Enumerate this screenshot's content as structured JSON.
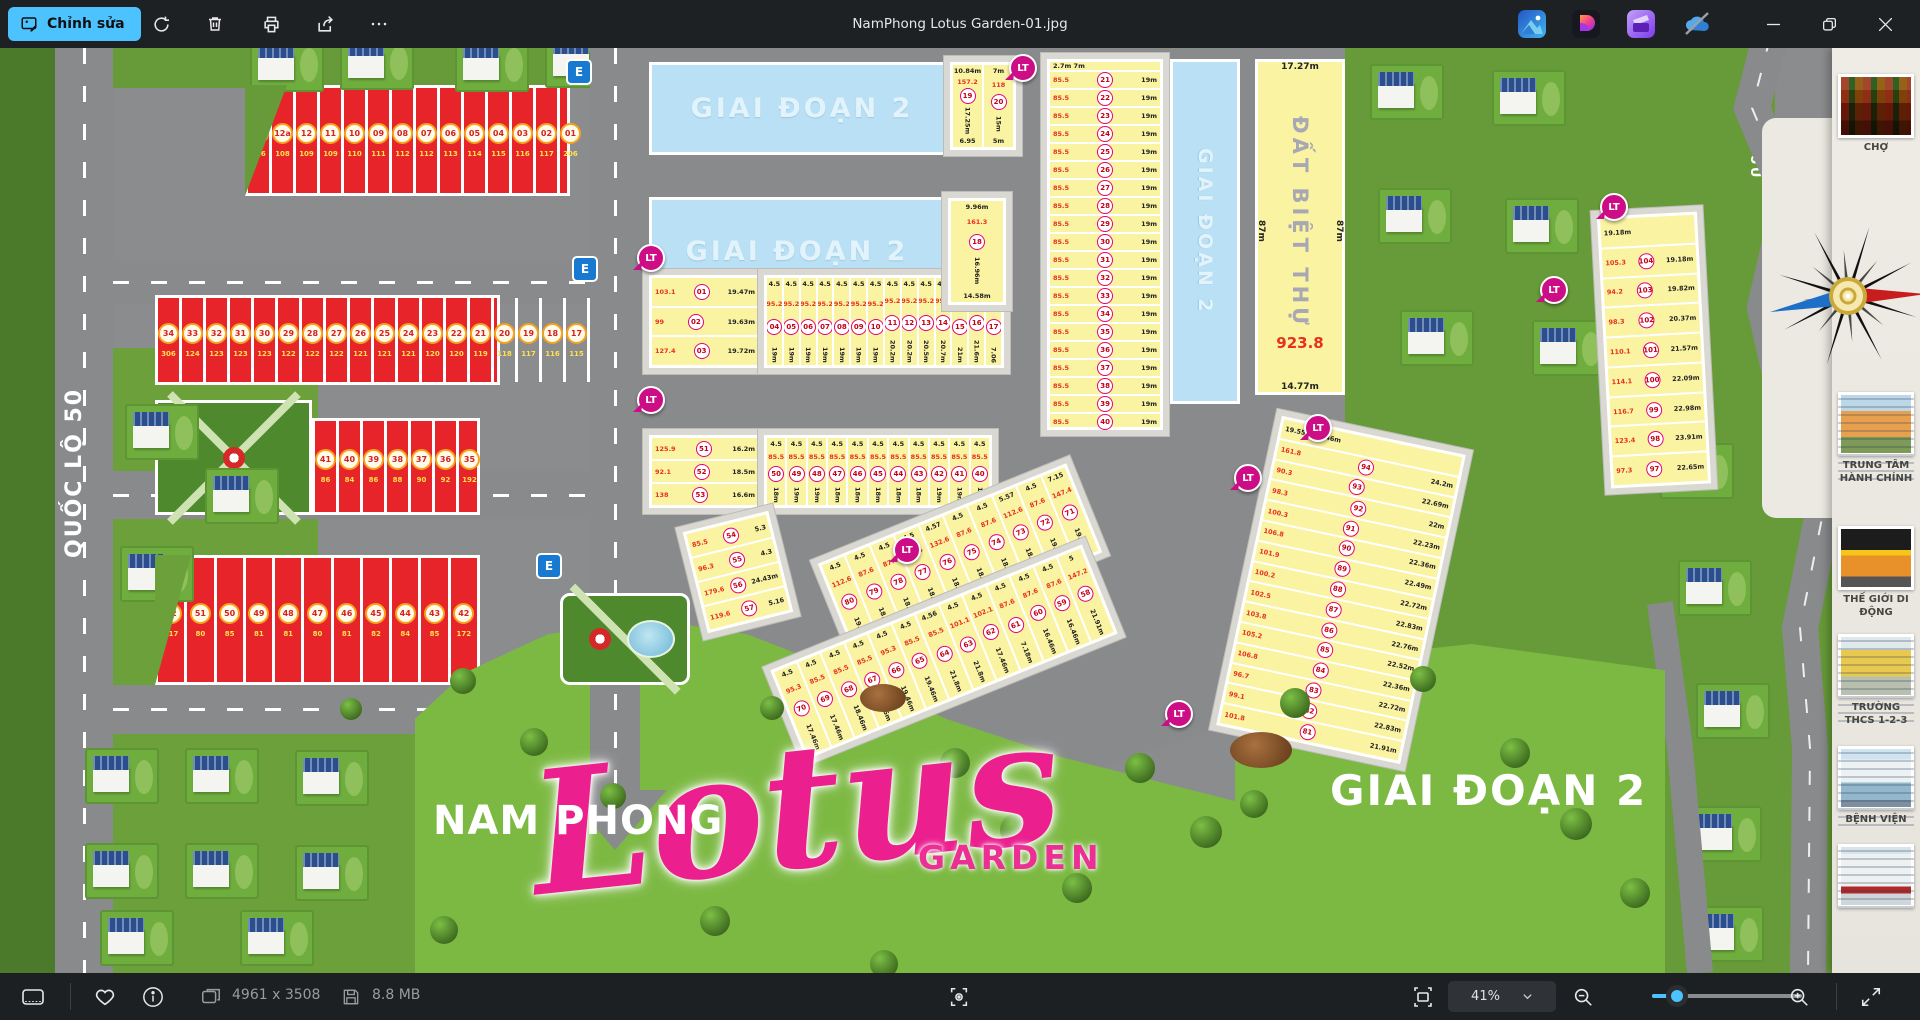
{
  "window": {
    "title": "NamPhong Lotus Garden-01.jpg"
  },
  "toolbar": {
    "edit_label": "Chỉnh sửa"
  },
  "statusbar": {
    "dimensions": "4961 x 3508",
    "filesize": "8.8 MB",
    "zoom_value": "41%"
  },
  "map": {
    "phase2_label": "GIAI ĐOẠN 2",
    "logo": {
      "line1": "NAM PHONG",
      "script": "Lotus",
      "line2": "GARDEN"
    },
    "roads": {
      "ql50": "QUỐC LỘ 50",
      "existing": "ĐƯỜNG HIỆN HỮU"
    },
    "villa_strip": {
      "label": "ĐẤT BIỆT THỰ",
      "area": "923.8",
      "dim_top": "17.27m",
      "dim_side_l": "87m",
      "dim_side_r": "87m",
      "dim_bottom": "14.77m"
    },
    "markers": {
      "lt": "LT",
      "e": "E"
    },
    "red_blocks": {
      "a": [
        {
          "n": "14",
          "a": "316"
        },
        {
          "n": "12a",
          "a": "108"
        },
        {
          "n": "12",
          "a": "109"
        },
        {
          "n": "11",
          "a": "109"
        },
        {
          "n": "10",
          "a": "110"
        },
        {
          "n": "09",
          "a": "111"
        },
        {
          "n": "08",
          "a": "112"
        },
        {
          "n": "07",
          "a": "112"
        },
        {
          "n": "06",
          "a": "113"
        },
        {
          "n": "05",
          "a": "114"
        },
        {
          "n": "04",
          "a": "115"
        },
        {
          "n": "03",
          "a": "116"
        },
        {
          "n": "02",
          "a": "117"
        },
        {
          "n": "01",
          "a": "206"
        }
      ],
      "b": [
        {
          "n": "34",
          "a": "306"
        },
        {
          "n": "33",
          "a": "124"
        },
        {
          "n": "32",
          "a": "123"
        },
        {
          "n": "31",
          "a": "123"
        },
        {
          "n": "30",
          "a": "123"
        },
        {
          "n": "29",
          "a": "122"
        },
        {
          "n": "28",
          "a": "122"
        },
        {
          "n": "27",
          "a": "122"
        },
        {
          "n": "26",
          "a": "121"
        },
        {
          "n": "25",
          "a": "121"
        },
        {
          "n": "24",
          "a": "121"
        },
        {
          "n": "23",
          "a": "120"
        },
        {
          "n": "22",
          "a": "120"
        },
        {
          "n": "21",
          "a": "119"
        },
        {
          "n": "20",
          "a": "118"
        },
        {
          "n": "19",
          "a": "117"
        },
        {
          "n": "18",
          "a": "116"
        },
        {
          "n": "17",
          "a": "115"
        },
        {
          "n": "16",
          "a": "110"
        },
        {
          "n": "15",
          "a": "109"
        }
      ],
      "c": [
        {
          "n": "41",
          "a": "86"
        },
        {
          "n": "40",
          "a": "84"
        },
        {
          "n": "39",
          "a": "86"
        },
        {
          "n": "38",
          "a": "88"
        },
        {
          "n": "37",
          "a": "90"
        },
        {
          "n": "36",
          "a": "92"
        },
        {
          "n": "35",
          "a": "192"
        }
      ],
      "d": [
        {
          "n": "52",
          "a": "217"
        },
        {
          "n": "51",
          "a": "80"
        },
        {
          "n": "50",
          "a": "85"
        },
        {
          "n": "49",
          "a": "81"
        },
        {
          "n": "48",
          "a": "81"
        },
        {
          "n": "47",
          "a": "80"
        },
        {
          "n": "46",
          "a": "81"
        },
        {
          "n": "45",
          "a": "82"
        },
        {
          "n": "44",
          "a": "84"
        },
        {
          "n": "43",
          "a": "85"
        },
        {
          "n": "42",
          "a": "172"
        }
      ]
    },
    "yellow": {
      "col_right": {
        "header": "2.7m  7m",
        "rows": [
          {
            "n": "21",
            "a": "85.5",
            "d1": "4.5",
            "d2": "19m"
          },
          {
            "n": "22",
            "a": "85.5",
            "d1": "4.5",
            "d2": "19m"
          },
          {
            "n": "23",
            "a": "85.5",
            "d1": "4.5",
            "d2": "19m"
          },
          {
            "n": "24",
            "a": "85.5",
            "d1": "4.5",
            "d2": "19m"
          },
          {
            "n": "25",
            "a": "85.5",
            "d1": "4.5",
            "d2": "19m"
          },
          {
            "n": "26",
            "a": "85.5",
            "d1": "4.5",
            "d2": "19m"
          },
          {
            "n": "27",
            "a": "85.5",
            "d1": "4.5",
            "d2": "19m"
          },
          {
            "n": "28",
            "a": "85.5",
            "d1": "4.5",
            "d2": "19m"
          },
          {
            "n": "29",
            "a": "85.5",
            "d1": "4.5",
            "d2": "19m"
          },
          {
            "n": "30",
            "a": "85.5",
            "d1": "4.5",
            "d2": "19m"
          },
          {
            "n": "31",
            "a": "85.5",
            "d1": "4.5",
            "d2": "19m"
          },
          {
            "n": "32",
            "a": "85.5",
            "d1": "4.5",
            "d2": "19m"
          },
          {
            "n": "33",
            "a": "85.5",
            "d1": "4.5",
            "d2": "19m"
          },
          {
            "n": "34",
            "a": "85.5",
            "d1": "4.5",
            "d2": "19m"
          },
          {
            "n": "35",
            "a": "85.5",
            "d1": "4.5",
            "d2": "19m"
          },
          {
            "n": "36",
            "a": "85.5",
            "d1": "4.5",
            "d2": "19m"
          },
          {
            "n": "37",
            "a": "85.5",
            "d1": "4.5",
            "d2": "19m"
          },
          {
            "n": "38",
            "a": "85.5",
            "d1": "4.5",
            "d2": "19m"
          },
          {
            "n": "39",
            "a": "85.5",
            "d1": "4.5",
            "d2": "19m"
          },
          {
            "n": "40",
            "a": "85.5",
            "d1": "4.5",
            "d2": "19m"
          }
        ]
      },
      "row1": {
        "left": [
          {
            "n": "01",
            "a": "103.1",
            "d": "19.47m"
          },
          {
            "n": "02",
            "a": "99",
            "d": "19.63m"
          },
          {
            "n": "03",
            "a": "127.4",
            "d": "19.72m"
          }
        ],
        "cells": [
          {
            "n": "04",
            "a": "95.2",
            "d1": "4.5",
            "d2": "19m"
          },
          {
            "n": "05",
            "a": "95.2",
            "d1": "4.5",
            "d2": "19m"
          },
          {
            "n": "06",
            "a": "95.2",
            "d1": "4.5",
            "d2": "19m"
          },
          {
            "n": "07",
            "a": "95.2",
            "d1": "4.5",
            "d2": "19m"
          },
          {
            "n": "08",
            "a": "95.2",
            "d1": "4.5",
            "d2": "19m"
          },
          {
            "n": "09",
            "a": "95.2",
            "d1": "4.5",
            "d2": "19m"
          },
          {
            "n": "10",
            "a": "95.2",
            "d1": "4.5",
            "d2": "19m"
          },
          {
            "n": "11",
            "a": "95.2",
            "d1": "4.5",
            "d2": "20.2m"
          },
          {
            "n": "12",
            "a": "95.2",
            "d1": "4.5",
            "d2": "20.2m"
          },
          {
            "n": "13",
            "a": "95.2",
            "d1": "4.5",
            "d2": "20.5m"
          },
          {
            "n": "14",
            "a": "95.2",
            "d1": "4.5",
            "d2": "20.7m"
          },
          {
            "n": "15",
            "a": "95.2",
            "d1": "4.5",
            "d2": "21m"
          },
          {
            "n": "16",
            "a": "100.1",
            "d1": "4.5",
            "d2": "21.6m"
          },
          {
            "n": "17",
            "a": "105.1",
            "d1": "4.5",
            "d2": "7.06"
          }
        ]
      },
      "row2": {
        "left": [
          {
            "n": "51",
            "a": "125.9",
            "d": "16.2m"
          },
          {
            "n": "52",
            "a": "92.1",
            "d": "18.5m"
          },
          {
            "n": "53",
            "a": "138",
            "d": "16.6m"
          }
        ],
        "cells": [
          {
            "n": "50",
            "a": "85.5",
            "d1": "4.5",
            "d2": "18m"
          },
          {
            "n": "49",
            "a": "85.5",
            "d1": "4.5",
            "d2": "19m"
          },
          {
            "n": "48",
            "a": "85.5",
            "d1": "4.5",
            "d2": "19m"
          },
          {
            "n": "47",
            "a": "85.5",
            "d1": "4.5",
            "d2": "18m"
          },
          {
            "n": "46",
            "a": "85.5",
            "d1": "4.5",
            "d2": "18m"
          },
          {
            "n": "45",
            "a": "85.5",
            "d1": "4.5",
            "d2": "18m"
          },
          {
            "n": "44",
            "a": "85.5",
            "d1": "4.5",
            "d2": "18m"
          },
          {
            "n": "43",
            "a": "85.5",
            "d1": "4.5",
            "d2": "18m"
          },
          {
            "n": "42",
            "a": "85.5",
            "d1": "4.5",
            "d2": "19m"
          },
          {
            "n": "41",
            "a": "85.5",
            "d1": "4.5",
            "d2": "19m"
          },
          {
            "n": "40",
            "a": "85.5",
            "d1": "4.5",
            "d2": "19m"
          }
        ]
      },
      "block54": [
        {
          "n": "54",
          "a": "85.5",
          "d": "5.3"
        },
        {
          "n": "55",
          "a": "96.3",
          "d": "4.3"
        },
        {
          "n": "56",
          "a": "179.6",
          "d": "24.43m"
        },
        {
          "n": "57",
          "a": "119.6",
          "d": "5.16"
        }
      ],
      "fan_upper": [
        {
          "n": "80",
          "a": "112.6",
          "d1": "4.5",
          "d2": "19.77m"
        },
        {
          "n": "79",
          "a": "87.6",
          "d1": "4.5",
          "d2": "18.47m"
        },
        {
          "n": "78",
          "a": "87.6",
          "d1": "4.5",
          "d2": "18.47m"
        },
        {
          "n": "77",
          "a": "87.6",
          "d1": "4.5",
          "d2": "18.47m"
        },
        {
          "n": "76",
          "a": "132.6",
          "d1": "4.57",
          "d2": "18.47m"
        },
        {
          "n": "75",
          "a": "87.6",
          "d1": "4.5",
          "d2": "18.47m"
        },
        {
          "n": "74",
          "a": "87.6",
          "d1": "4.5",
          "d2": "18.47m"
        },
        {
          "n": "73",
          "a": "112.6",
          "d1": "5.57",
          "d2": "18.47m"
        },
        {
          "n": "72",
          "a": "87.6",
          "d1": "4.5",
          "d2": "19.47m"
        },
        {
          "n": "71",
          "a": "147.4",
          "d1": "7.15",
          "d2": "19.47m"
        }
      ],
      "fan_lower": [
        {
          "n": "70",
          "a": "95.3",
          "d1": "4.5",
          "d2": "17.46m"
        },
        {
          "n": "69",
          "a": "85.5",
          "d1": "4.5",
          "d2": "17.46m"
        },
        {
          "n": "68",
          "a": "85.5",
          "d1": "4.5",
          "d2": "18.46m"
        },
        {
          "n": "67",
          "a": "85.5",
          "d1": "4.5",
          "d2": "18.46m"
        },
        {
          "n": "66",
          "a": "95.3",
          "d1": "4.5",
          "d2": "19.46m"
        },
        {
          "n": "65",
          "a": "85.5",
          "d1": "4.5",
          "d2": "19.46m"
        },
        {
          "n": "64",
          "a": "85.5",
          "d1": "4.56",
          "d2": "21.8m"
        },
        {
          "n": "63",
          "a": "101.1",
          "d1": "4.5",
          "d2": "21.8m"
        },
        {
          "n": "62",
          "a": "102.1",
          "d1": "4.5",
          "d2": "17.46m"
        },
        {
          "n": "61",
          "a": "87.6",
          "d1": "4.5",
          "d2": "7.18m"
        },
        {
          "n": "60",
          "a": "87.6",
          "d1": "4.5",
          "d2": "16.46m"
        },
        {
          "n": "59",
          "a": "87.6",
          "d1": "4.5",
          "d2": "16.46m"
        },
        {
          "n": "58",
          "a": "147.2",
          "d1": "5",
          "d2": "21.91m"
        }
      ],
      "bigcol": {
        "header": "19.55m      20.46m",
        "rows": [
          {
            "a": "161.8",
            "n": "94",
            "d": "24.2m"
          },
          {
            "a": "90.3",
            "n": "93",
            "d": "22.69m"
          },
          {
            "a": "98.3",
            "n": "92",
            "d": "22m"
          },
          {
            "a": "100.3",
            "n": "91",
            "d": "22.23m"
          },
          {
            "a": "106.8",
            "n": "90",
            "d": "22.36m"
          },
          {
            "a": "101.9",
            "n": "89",
            "d": "22.49m"
          },
          {
            "a": "100.2",
            "n": "88",
            "d": "22.72m"
          },
          {
            "a": "102.5",
            "n": "87",
            "d": "22.83m"
          },
          {
            "a": "103.8",
            "n": "86",
            "d": "22.76m"
          },
          {
            "a": "105.2",
            "n": "85",
            "d": "22.52m"
          },
          {
            "a": "106.8",
            "n": "84",
            "d": "22.36m"
          },
          {
            "a": "96.7",
            "n": "83",
            "d": "22.72m"
          },
          {
            "a": "99.1",
            "n": "82",
            "d": "22.83m"
          },
          {
            "a": "101.8",
            "n": "81",
            "d": "21.91m"
          }
        ]
      },
      "rightcol": {
        "header": "19.18m",
        "rows": [
          {
            "a": "105.3",
            "n": "104",
            "d": "19.18m"
          },
          {
            "a": "94.2",
            "n": "103",
            "d": "19.82m"
          },
          {
            "a": "98.3",
            "n": "102",
            "d": "20.37m"
          },
          {
            "a": "110.1",
            "n": "101",
            "d": "21.57m"
          },
          {
            "a": "114.1",
            "n": "100",
            "d": "22.09m"
          },
          {
            "a": "116.7",
            "n": "99",
            "d": "22.98m"
          },
          {
            "a": "123.4",
            "n": "98",
            "d": "23.91m"
          },
          {
            "a": "97.3",
            "n": "97",
            "d": "22.65m"
          }
        ]
      },
      "lots1920": [
        {
          "n": "19",
          "a": "157.2",
          "d1": "10.84m",
          "d2": "17.25m",
          "d3": "6.95"
        },
        {
          "n": "20",
          "a": "118",
          "d1": "7m",
          "d2": "15m",
          "d3": "5m"
        }
      ],
      "lot18": {
        "n": "18",
        "a": "161.3",
        "d1": "9.96m",
        "d2": "16.96m",
        "d3": "14.58m"
      }
    },
    "sidebar": [
      {
        "label": "CHỢ",
        "photo": "market"
      },
      {
        "label": "TRUNG TÂM HÀNH CHÍNH",
        "photo": "admin"
      },
      {
        "label": "THẾ GIỚI DI ĐỘNG",
        "photo": "tgdd"
      },
      {
        "label": "TRƯỜNG THCS 1-2-3",
        "photo": "school"
      },
      {
        "label": "BỆNH VIỆN",
        "photo": "hospital"
      },
      {
        "label": "",
        "photo": "bank"
      }
    ]
  }
}
